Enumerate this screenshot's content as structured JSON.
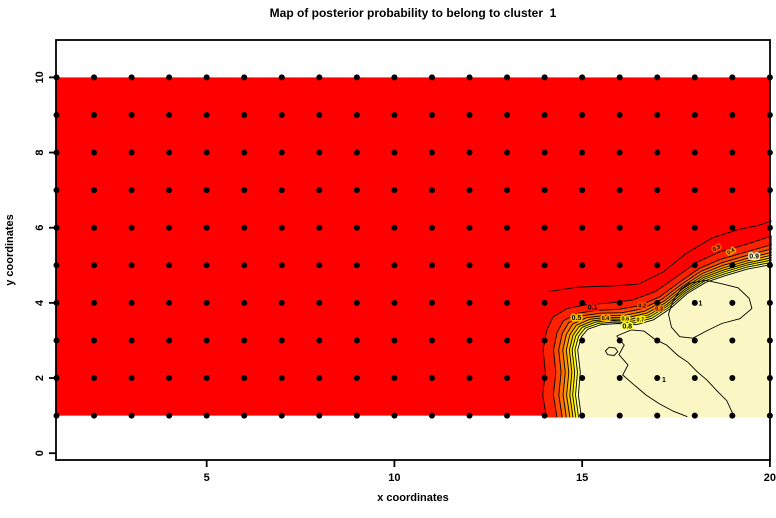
{
  "title": "Map of posterior probability to belong to cluster  1",
  "axes": {
    "x_label": "x coordinates",
    "y_label": "y coordinates",
    "x_ticks": [
      "5",
      "10",
      "15",
      "20"
    ],
    "x_tick_values": [
      5,
      10,
      15,
      20
    ],
    "y_ticks": [
      "0",
      "2",
      "4",
      "6",
      "8",
      "10"
    ],
    "y_tick_values": [
      0,
      2,
      4,
      6,
      8,
      10
    ]
  },
  "chart_data": {
    "type": "heatmap",
    "title": "Map of posterior probability to belong to cluster  1",
    "xlabel": "x coordinates",
    "ylabel": "y coordinates",
    "xlim": [
      1,
      20
    ],
    "ylim": [
      0,
      10.95
    ],
    "grid_on": false,
    "description": "Filled contour map of posterior probability of cluster 1 over a 20 x 10 integer grid. Probability is ~0 (red) over most of the domain and ~1 (pale cream) in the lower-right corner (x>15, y<4 rising to y~5 at x=20), with a tight transition band of contour levels 0.1-0.9.",
    "field_colors": {
      "low": "#FF0000",
      "high": "#FBF7C4",
      "dot": "#000000",
      "contour_line": "#000000"
    },
    "field_extent": {
      "x": [
        1,
        20
      ],
      "y": [
        1,
        10
      ]
    },
    "grid_points": {
      "x_from": 1,
      "x_to": 20,
      "y_from": 1,
      "y_to": 10,
      "step": 1,
      "marker": "filled-circle"
    },
    "contour_levels": [
      0.1,
      0.2,
      0.3,
      0.4,
      0.5,
      0.6,
      0.7,
      0.8,
      0.9,
      1
    ],
    "band": {
      "red_side": [
        [
          14.05,
          0.95
        ],
        [
          13.95,
          1.55
        ],
        [
          14.02,
          2.15
        ],
        [
          13.96,
          2.75
        ],
        [
          14.05,
          3.25
        ],
        [
          14.22,
          3.62
        ],
        [
          14.6,
          3.85
        ],
        [
          15.1,
          3.95
        ],
        [
          15.75,
          4.0
        ],
        [
          16.35,
          4.08
        ],
        [
          16.95,
          4.3
        ],
        [
          17.5,
          4.68
        ],
        [
          18.05,
          5.08
        ],
        [
          18.65,
          5.35
        ],
        [
          19.35,
          5.55
        ],
        [
          20.05,
          5.78
        ]
      ],
      "cream_side": [
        [
          14.98,
          0.95
        ],
        [
          14.9,
          1.55
        ],
        [
          14.95,
          2.15
        ],
        [
          14.88,
          2.75
        ],
        [
          14.98,
          3.1
        ],
        [
          15.15,
          3.3
        ],
        [
          15.5,
          3.42
        ],
        [
          15.95,
          3.45
        ],
        [
          16.45,
          3.42
        ],
        [
          16.9,
          3.55
        ],
        [
          17.35,
          3.85
        ],
        [
          17.8,
          4.25
        ],
        [
          18.3,
          4.55
        ],
        [
          18.8,
          4.72
        ],
        [
          19.4,
          4.9
        ],
        [
          20.05,
          5.02
        ]
      ],
      "fractions": [
        0,
        0.3,
        0.45,
        0.57,
        0.67,
        0.76,
        0.84,
        0.92,
        1.0
      ],
      "strip_colors": [
        "#FF2000",
        "#FF4800",
        "#FF7000",
        "#FF9800",
        "#FFC000",
        "#FFE400",
        "#FFFF20",
        "#FFFF90"
      ]
    },
    "extra_contours": [
      {
        "name": "outer-01-contour",
        "closed": false,
        "points": [
          [
            14.1,
            4.3
          ],
          [
            14.9,
            4.42
          ],
          [
            15.8,
            4.45
          ],
          [
            16.5,
            4.5
          ],
          [
            17.15,
            4.82
          ],
          [
            17.75,
            5.3
          ],
          [
            18.45,
            5.72
          ],
          [
            19.15,
            5.95
          ],
          [
            19.65,
            6.05
          ],
          [
            20.05,
            6.18
          ]
        ]
      },
      {
        "name": "level1-blob",
        "closed": true,
        "points": [
          [
            17.85,
            4.52
          ],
          [
            18.3,
            4.6
          ],
          [
            18.75,
            4.5
          ],
          [
            19.15,
            4.4
          ],
          [
            19.45,
            4.12
          ],
          [
            19.52,
            3.85
          ],
          [
            19.2,
            3.58
          ],
          [
            18.72,
            3.45
          ],
          [
            18.3,
            3.25
          ],
          [
            17.95,
            3.06
          ],
          [
            17.6,
            3.1
          ],
          [
            17.38,
            3.35
          ],
          [
            17.3,
            3.7
          ],
          [
            17.42,
            4.05
          ],
          [
            17.62,
            4.35
          ]
        ]
      },
      {
        "name": "level1-lower-left",
        "closed": false,
        "points": [
          [
            15.92,
            3.12
          ],
          [
            16.12,
            2.88
          ],
          [
            15.98,
            2.62
          ],
          [
            16.22,
            2.35
          ],
          [
            16.08,
            2.08
          ],
          [
            16.38,
            1.82
          ],
          [
            16.7,
            1.55
          ],
          [
            17.05,
            1.32
          ],
          [
            17.42,
            1.12
          ],
          [
            17.8,
            0.97
          ]
        ]
      },
      {
        "name": "level1-lower-right",
        "closed": false,
        "points": [
          [
            15.92,
            3.12
          ],
          [
            16.3,
            3.28
          ],
          [
            16.65,
            3.25
          ],
          [
            16.95,
            3.02
          ],
          [
            17.25,
            2.88
          ],
          [
            17.55,
            2.6
          ],
          [
            17.82,
            2.42
          ],
          [
            18.05,
            2.18
          ],
          [
            18.32,
            1.95
          ],
          [
            18.6,
            1.65
          ],
          [
            18.85,
            1.4
          ],
          [
            19.05,
            0.97
          ]
        ]
      },
      {
        "name": "level1-small-loop",
        "closed": true,
        "points": [
          [
            15.62,
            2.72
          ],
          [
            15.72,
            2.82
          ],
          [
            15.88,
            2.8
          ],
          [
            15.95,
            2.7
          ],
          [
            15.85,
            2.6
          ],
          [
            15.68,
            2.62
          ]
        ]
      }
    ],
    "contour_labels": [
      {
        "text": "0.1",
        "x": 15.28,
        "y": 3.82,
        "size": 7,
        "halo": "#FF1400",
        "rot": 0
      },
      {
        "text": "0.2",
        "x": 16.6,
        "y": 3.88,
        "size": 5.5,
        "halo": "#FF5200",
        "rot": 0
      },
      {
        "text": "0.3",
        "x": 17.05,
        "y": 3.8,
        "size": 5.5,
        "halo": "#FF7A00",
        "rot": 0
      },
      {
        "text": "0.5",
        "x": 14.85,
        "y": 3.55,
        "size": 7,
        "halo": "#FFC000",
        "rot": 0
      },
      {
        "text": "0.4",
        "x": 15.62,
        "y": 3.55,
        "size": 5.5,
        "halo": "#FFA800",
        "rot": 0
      },
      {
        "text": "0.6",
        "x": 16.15,
        "y": 3.53,
        "size": 5.5,
        "halo": "#FFE400",
        "rot": 0
      },
      {
        "text": "0.7",
        "x": 16.55,
        "y": 3.5,
        "size": 5.5,
        "halo": "#FFF000",
        "rot": 0
      },
      {
        "text": "0.8",
        "x": 16.2,
        "y": 3.32,
        "size": 7,
        "halo": "#FFFF40",
        "rot": 0
      },
      {
        "text": "0.3",
        "x": 18.6,
        "y": 5.42,
        "size": 5.5,
        "halo": "#FF5200",
        "rot": -28
      },
      {
        "text": "0.4",
        "x": 18.98,
        "y": 5.33,
        "size": 5.5,
        "halo": "#FF9800",
        "rot": -28
      },
      {
        "text": "0.9",
        "x": 19.58,
        "y": 5.18,
        "size": 7,
        "halo": "#FBF7C4",
        "rot": 0
      },
      {
        "text": "1",
        "x": 18.15,
        "y": 3.93,
        "size": 7,
        "halo": "#FBF7C4",
        "rot": 0
      },
      {
        "text": "1",
        "x": 17.18,
        "y": 1.9,
        "size": 7,
        "halo": "#FBF7C4",
        "rot": 0
      }
    ]
  }
}
